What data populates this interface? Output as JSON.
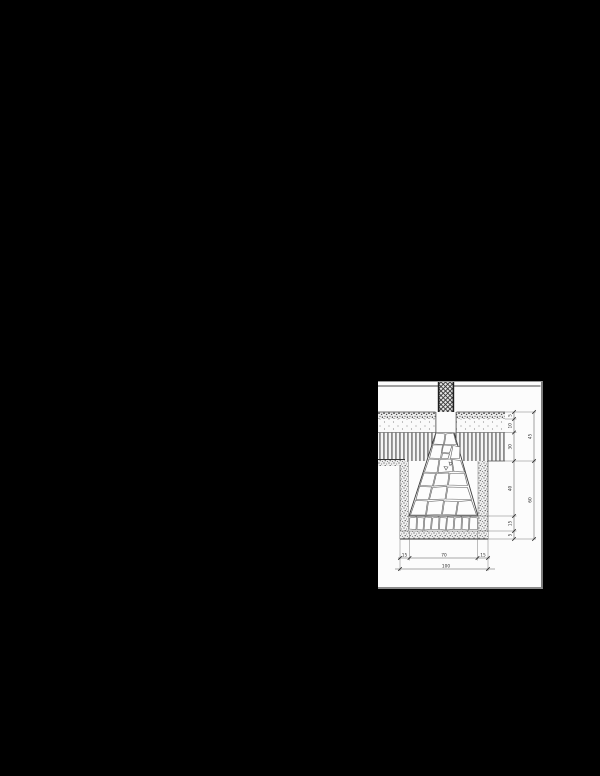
{
  "window": {
    "width": 600,
    "height": 776,
    "background": "#000000"
  },
  "drawing": {
    "type": "construction-detail-section",
    "description": "Stone strip foundation under masonry wall with floor layers, excavation backfill and dimension chains",
    "dims": {
      "right_inner": [
        "5",
        "10",
        "30",
        "40",
        "15",
        "5"
      ],
      "right_outer": [
        "45",
        "60"
      ],
      "bottom": [
        "15",
        "70",
        "15"
      ],
      "bottom_total": "100"
    },
    "colors": {
      "paper": "#fcfcfc",
      "line": "#4a4a4a",
      "dim_line": "#555555",
      "background": "#000000"
    }
  }
}
